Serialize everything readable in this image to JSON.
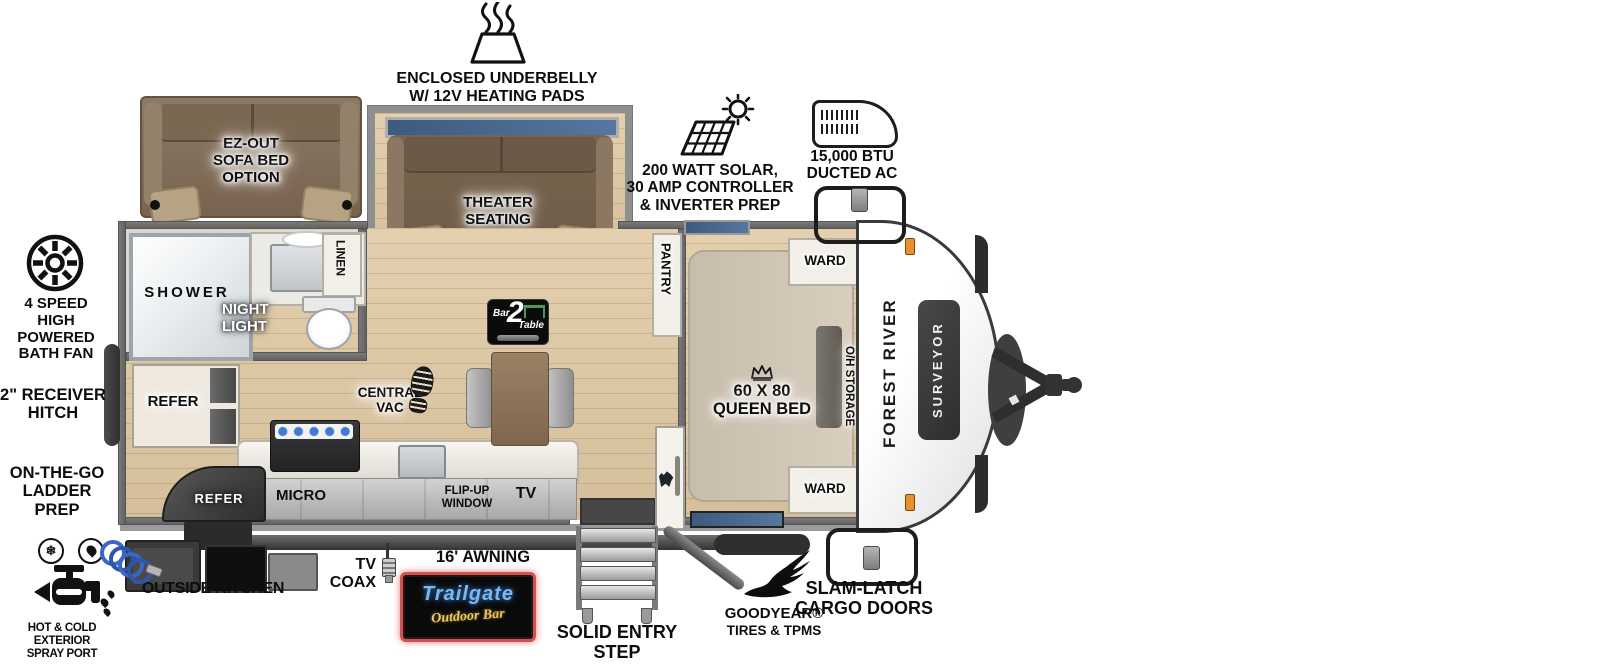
{
  "title": "Forest River Surveyor travel trailer floorplan",
  "colors": {
    "floor_wood": "#ddc8a6",
    "wall_gray": "#6f6f6f",
    "sofa_brown": "#7a6753",
    "window_blue": "#44618a",
    "marker_orange": "#e8912a",
    "trailgate_neon_red": "#d84f4f",
    "trailgate_blue": "#7cb8ea",
    "trailgate_yellow": "#eac95f",
    "bar2table_green": "#4c9a55"
  },
  "exterior_callouts": {
    "underbelly": {
      "line1": "ENCLOSED UNDERBELLY",
      "line2": "W/ 12V HEATING PADS"
    },
    "solar": {
      "line1": "200 WATT SOLAR,",
      "line2": "30 AMP CONTROLLER",
      "line3": "& INVERTER PREP"
    },
    "ducted_ac": {
      "line1": "15,000 BTU",
      "line2": "DUCTED AC"
    },
    "bath_fan": {
      "line1": "4 SPEED",
      "line2": "HIGH POWERED",
      "line3": "BATH FAN"
    },
    "receiver_hitch": {
      "line1": "2\" RECEIVER",
      "line2": "HITCH"
    },
    "ladder_prep": {
      "line1": "ON-THE-GO",
      "line2": "LADDER PREP"
    },
    "spray_port": {
      "line1": "HOT & COLD EXTERIOR",
      "line2": "SPRAY PORT"
    },
    "outside_kitchen": "OUTSIDE KITCHEN",
    "tv_coax": {
      "line1": "TV",
      "line2": "COAX"
    },
    "awning": "16' AWNING",
    "entry_step": {
      "line1": "SOLID ENTRY",
      "line2": "STEP"
    },
    "goodyear": {
      "line1": "GOODYEAR®",
      "line2": "TIRES & TPMS"
    },
    "slam_latch": {
      "line1": "SLAM-LATCH",
      "line2": "CARGO DOORS"
    }
  },
  "interior_labels": {
    "sofa_option": {
      "line1": "EZ-OUT",
      "line2": "SOFA BED",
      "line3": "OPTION"
    },
    "theater": {
      "line1": "THEATER",
      "line2": "SEATING"
    },
    "shower": "SHOWER",
    "linen": "LINEN",
    "night_light": {
      "line1": "NIGHT",
      "line2": "LIGHT"
    },
    "refer": "REFER",
    "refer_exterior": "REFER",
    "micro": "MICRO",
    "central_vac": {
      "line1": "CENTRAL",
      "line2": "VAC"
    },
    "flip_up_window": {
      "line1": "FLIP-UP",
      "line2": "WINDOW"
    },
    "tv": "TV",
    "pantry": "PANTRY",
    "queen_bed": {
      "line1": "60 X 80",
      "line2": "QUEEN BED"
    },
    "ward_top": "WARD",
    "ward_bottom": "WARD",
    "oh_storage": "O/H STORAGE"
  },
  "branding": {
    "make": "FOREST RIVER",
    "model": "SURVEYOR",
    "bar2table": {
      "bar": "Bar",
      "two": "2",
      "table": "Table"
    },
    "trailgate": {
      "name": "Trailgate",
      "sub": "Outdoor Bar"
    }
  }
}
